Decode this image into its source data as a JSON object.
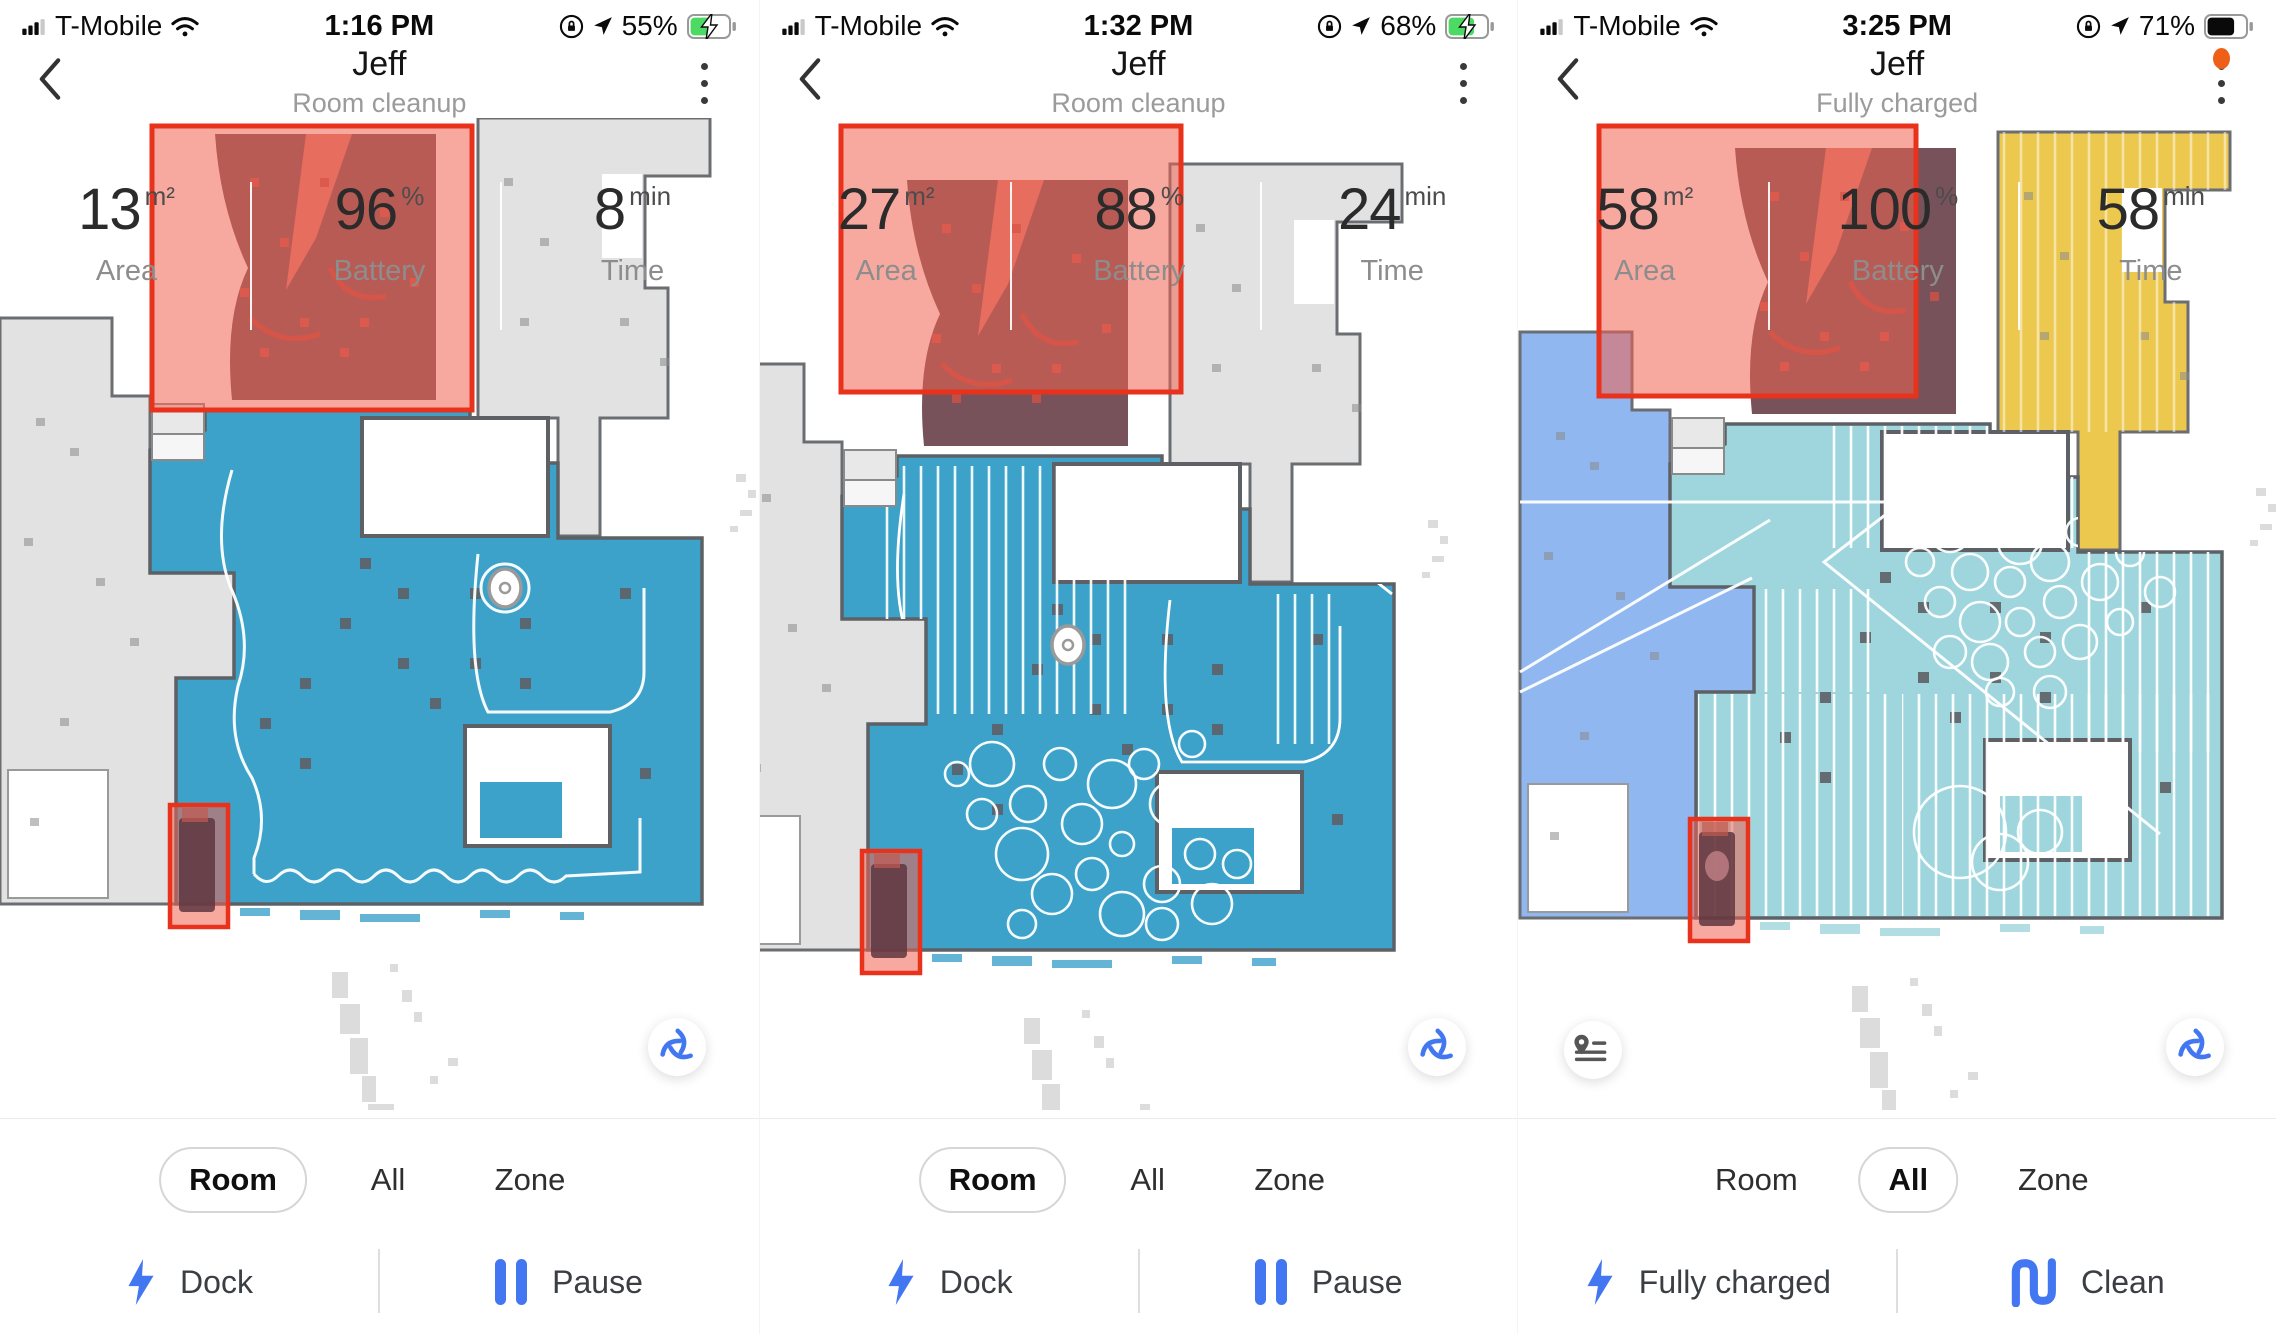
{
  "colors": {
    "accent_blue": "#4174f0",
    "selection_red": "#e8321c",
    "selection_fill": "rgba(240,98,82,0.55)",
    "floor_blue": "#3da2ca",
    "floor_teal": "#9fd5dc",
    "room_periwinkle": "#90b7f0",
    "room_yellow": "#ecc84e",
    "unexplored_gray": "#e2e2e2",
    "wall_gray": "#5d6166",
    "battery_green": "#4cd964",
    "notification_orange": "#ee5f18"
  },
  "panels": [
    {
      "status": {
        "carrier": "T-Mobile",
        "time": "1:16 PM",
        "battery_percent": "55%",
        "charging": true
      },
      "header": {
        "title": "Jeff",
        "subtitle": "Room cleanup"
      },
      "stats": {
        "area": {
          "value": "13",
          "unit": "m²",
          "label": "Area"
        },
        "battery": {
          "value": "96",
          "unit": "%",
          "label": "Battery"
        },
        "time": {
          "value": "8",
          "unit": "min",
          "label": "Time"
        }
      },
      "tabs": [
        {
          "label": "Room",
          "selected": true
        },
        {
          "label": "All",
          "selected": false
        },
        {
          "label": "Zone",
          "selected": false
        }
      ],
      "actions": [
        {
          "label": "Dock",
          "icon": "lightning-icon"
        },
        {
          "label": "Pause",
          "icon": "pause-icon"
        }
      ]
    },
    {
      "status": {
        "carrier": "T-Mobile",
        "time": "1:32 PM",
        "battery_percent": "68%",
        "charging": true
      },
      "header": {
        "title": "Jeff",
        "subtitle": "Room cleanup"
      },
      "stats": {
        "area": {
          "value": "27",
          "unit": "m²",
          "label": "Area"
        },
        "battery": {
          "value": "88",
          "unit": "%",
          "label": "Battery"
        },
        "time": {
          "value": "24",
          "unit": "min",
          "label": "Time"
        }
      },
      "tabs": [
        {
          "label": "Room",
          "selected": true
        },
        {
          "label": "All",
          "selected": false
        },
        {
          "label": "Zone",
          "selected": false
        }
      ],
      "actions": [
        {
          "label": "Dock",
          "icon": "lightning-icon"
        },
        {
          "label": "Pause",
          "icon": "pause-icon"
        }
      ]
    },
    {
      "status": {
        "carrier": "T-Mobile",
        "time": "3:25 PM",
        "battery_percent": "71%",
        "charging": false
      },
      "header": {
        "title": "Jeff",
        "subtitle": "Fully charged",
        "notification_dot": true
      },
      "stats": {
        "area": {
          "value": "58",
          "unit": "m²",
          "label": "Area"
        },
        "battery": {
          "value": "100",
          "unit": "%",
          "label": "Battery"
        },
        "time": {
          "value": "58",
          "unit": "min",
          "label": "Time"
        }
      },
      "tabs": [
        {
          "label": "Room",
          "selected": false
        },
        {
          "label": "All",
          "selected": true
        },
        {
          "label": "Zone",
          "selected": false
        }
      ],
      "actions": [
        {
          "label": "Fully charged",
          "icon": "lightning-icon"
        },
        {
          "label": "Clean",
          "icon": "clean-path-icon"
        }
      ]
    }
  ]
}
